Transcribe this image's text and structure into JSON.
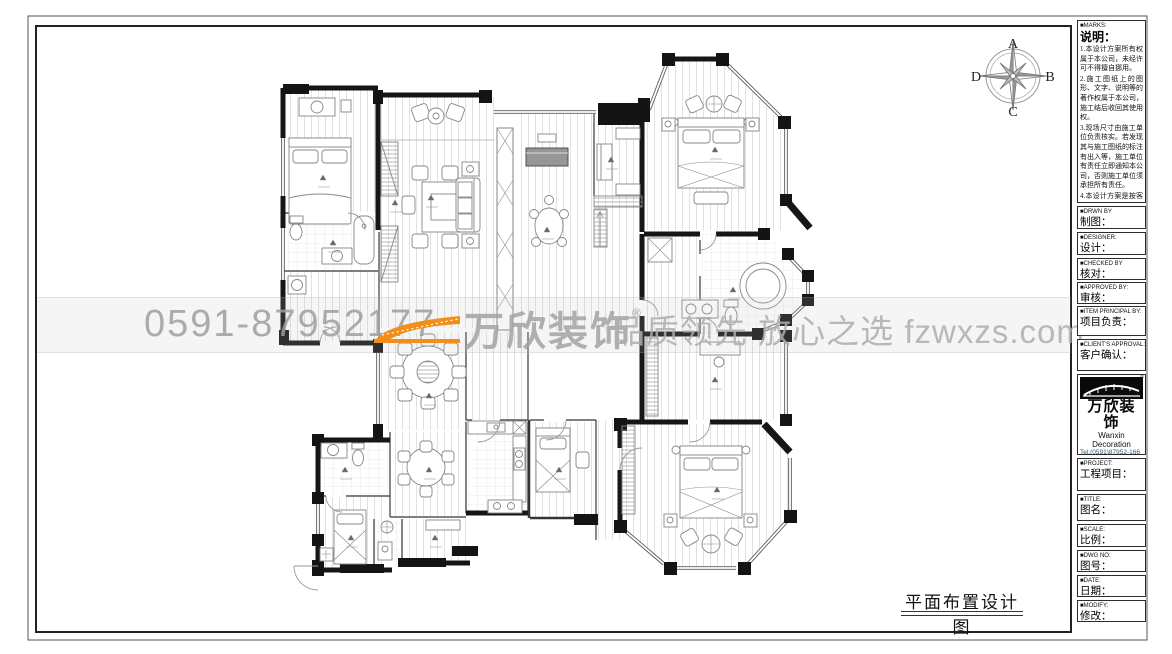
{
  "compass": {
    "n": "A",
    "e": "B",
    "s": "C",
    "w": "D"
  },
  "watermark": {
    "phone": "0591-87952177",
    "brand": "万欣装饰",
    "reg": "®",
    "slogan": "品质领先 放心之选 fzwxzs.com"
  },
  "drawing_title": "平面布置设计图",
  "title_block": {
    "marks": {
      "en": "■MARKS:",
      "cn": "说明：",
      "notes": [
        "1.本设计方案所有权属于本公司，未经许可不得擅自挪用。",
        "2.施工图纸上的图形、文字、说明等的著作权属于本公司，施工结后收回其使用权。",
        "3.现场尺寸由施工单位负责核实。若发现其与施工图纸的标注有出入等，施工单位有责任立即通知本公司，否则施工单位须承担所有责任。",
        "4.本设计方案是按客户要求设计，经客户签字即视为同意认可，不得随意更改。"
      ]
    },
    "drwn": {
      "en": "■DRWN BY",
      "cn": "制图："
    },
    "designer": {
      "en": "■DESIGNER:",
      "cn": "设计："
    },
    "checked": {
      "en": "■CHECKED BY",
      "cn": "核对："
    },
    "approved": {
      "en": "■APPROVED BY:",
      "cn": "审核："
    },
    "principal": {
      "en": "■ITEM PRINCIPAL BY:",
      "cn": "项目负责："
    },
    "client": {
      "en": "■CLIENT'S APPROVAL:",
      "cn": "客户确认："
    },
    "company": {
      "brand": "万欣装饰",
      "name_en": "Wanxin Decoration",
      "tel1": "Tel:(0591)87952-166",
      "tel2": "(0591)87952-177",
      "fax": "Fax:(0591)87952-199",
      "web": "Web:WWW.fzwxzs.com"
    },
    "project": {
      "en": "■PROJECT:",
      "cn": "工程项目："
    },
    "title": {
      "en": "■TITLE:",
      "cn": "图名："
    },
    "scale": {
      "en": "■SCALE:",
      "cn": "比例："
    },
    "dwg": {
      "en": "■DWG NO:",
      "cn": "图号："
    },
    "date": {
      "en": "■DATE:",
      "cn": "日期："
    },
    "modify": {
      "en": "■MODIFY:",
      "cn": "修改："
    }
  }
}
